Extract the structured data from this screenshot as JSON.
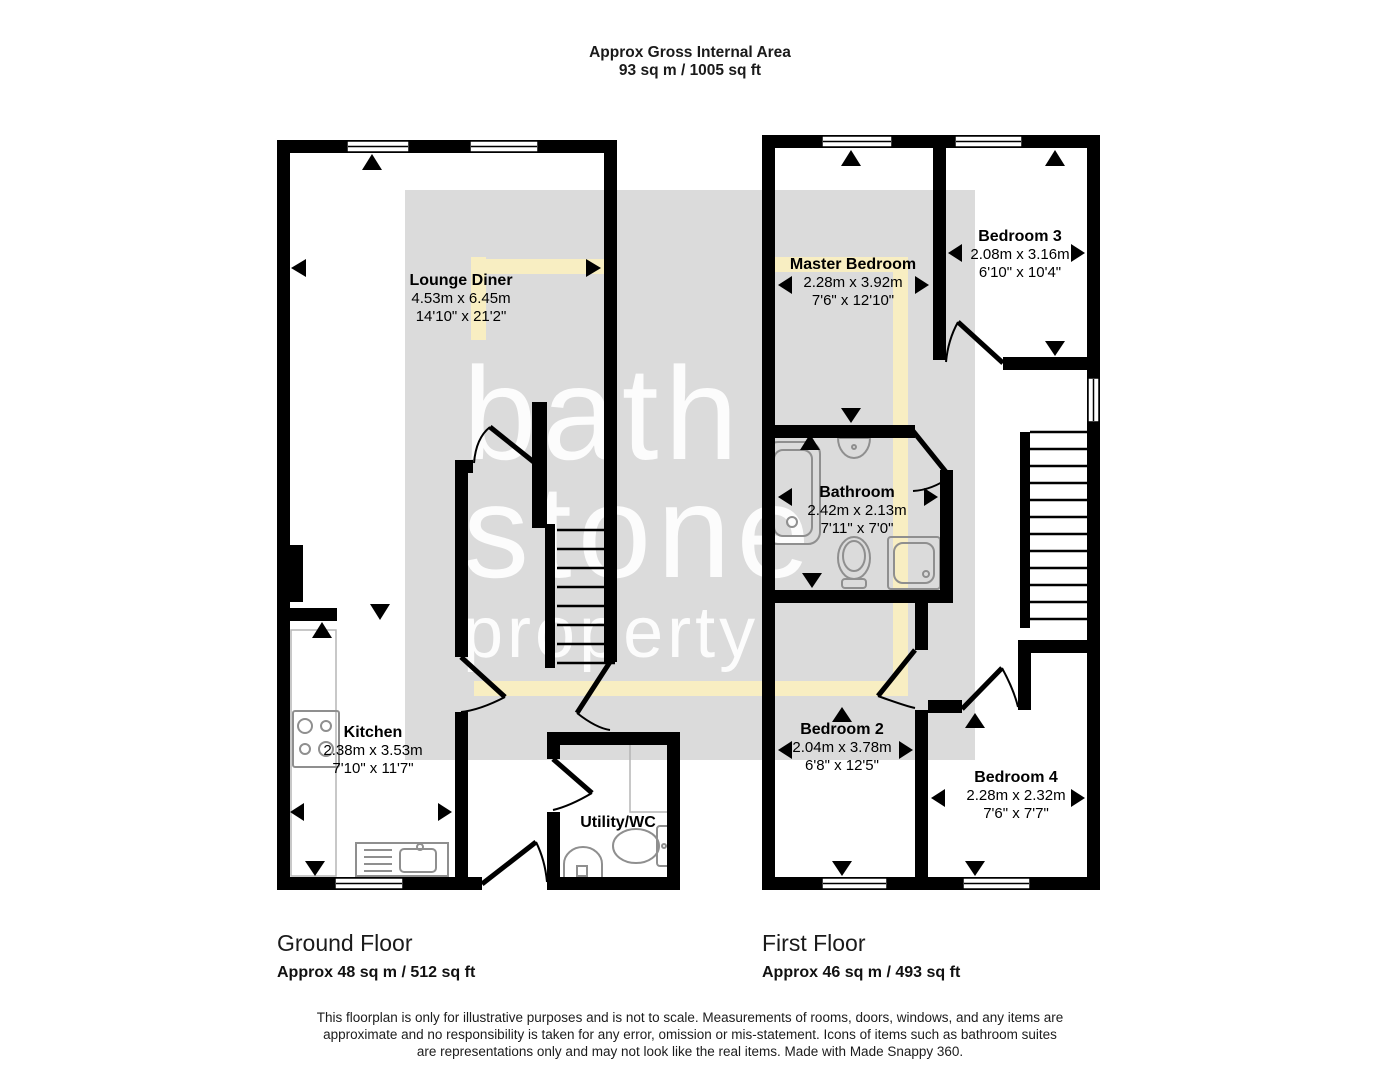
{
  "header": {
    "title_line1": "Approx Gross Internal Area",
    "title_line2": "93 sq m / 1005 sq ft"
  },
  "watermark": {
    "line1": "bath",
    "line2": "stone",
    "line3": "property"
  },
  "rooms": [
    {
      "id": "lounge",
      "name": "Lounge Diner",
      "metric": "4.53m x 6.45m",
      "imperial": "14'10\" x 21'2\""
    },
    {
      "id": "kitchen",
      "name": "Kitchen",
      "metric": "2.38m x 3.53m",
      "imperial": "7'10\" x 11'7\""
    },
    {
      "id": "utility",
      "name": "Utility/WC",
      "metric": "",
      "imperial": ""
    },
    {
      "id": "master",
      "name": "Master Bedroom",
      "metric": "2.28m x 3.92m",
      "imperial": "7'6\" x 12'10\""
    },
    {
      "id": "bed3",
      "name": "Bedroom 3",
      "metric": "2.08m x 3.16m",
      "imperial": "6'10\" x 10'4\""
    },
    {
      "id": "bathroom",
      "name": "Bathroom",
      "metric": "2.42m x 2.13m",
      "imperial": "7'11\" x 7'0\""
    },
    {
      "id": "bed2",
      "name": "Bedroom 2",
      "metric": "2.04m x 3.78m",
      "imperial": "6'8\" x 12'5\""
    },
    {
      "id": "bed4",
      "name": "Bedroom 4",
      "metric": "2.28m x 2.32m",
      "imperial": "7'6\" x 7'7\""
    }
  ],
  "floors": [
    {
      "id": "ground",
      "name": "Ground Floor",
      "area": "Approx 48 sq m / 512 sq ft"
    },
    {
      "id": "first",
      "name": "First Floor",
      "area": "Approx 46 sq m / 493 sq ft"
    }
  ],
  "footer": {
    "disclaimer_line1": "This floorplan is only for illustrative purposes and is not to scale. Measurements of rooms, doors, windows, and any items are",
    "disclaimer_line2": "approximate and no responsibility is taken for any error, omission or mis-statement. Icons of items such as bathroom suites",
    "disclaimer_line3": "are representations only and may not look like the real items. Made with Made Snappy 360."
  },
  "colors": {
    "wall": "#000000",
    "watermark_box": "#dbdbdb",
    "route_highlight": "#f8eec2",
    "fixture_stroke": "#8f8f8f",
    "watermark_text": "#ffffff"
  }
}
